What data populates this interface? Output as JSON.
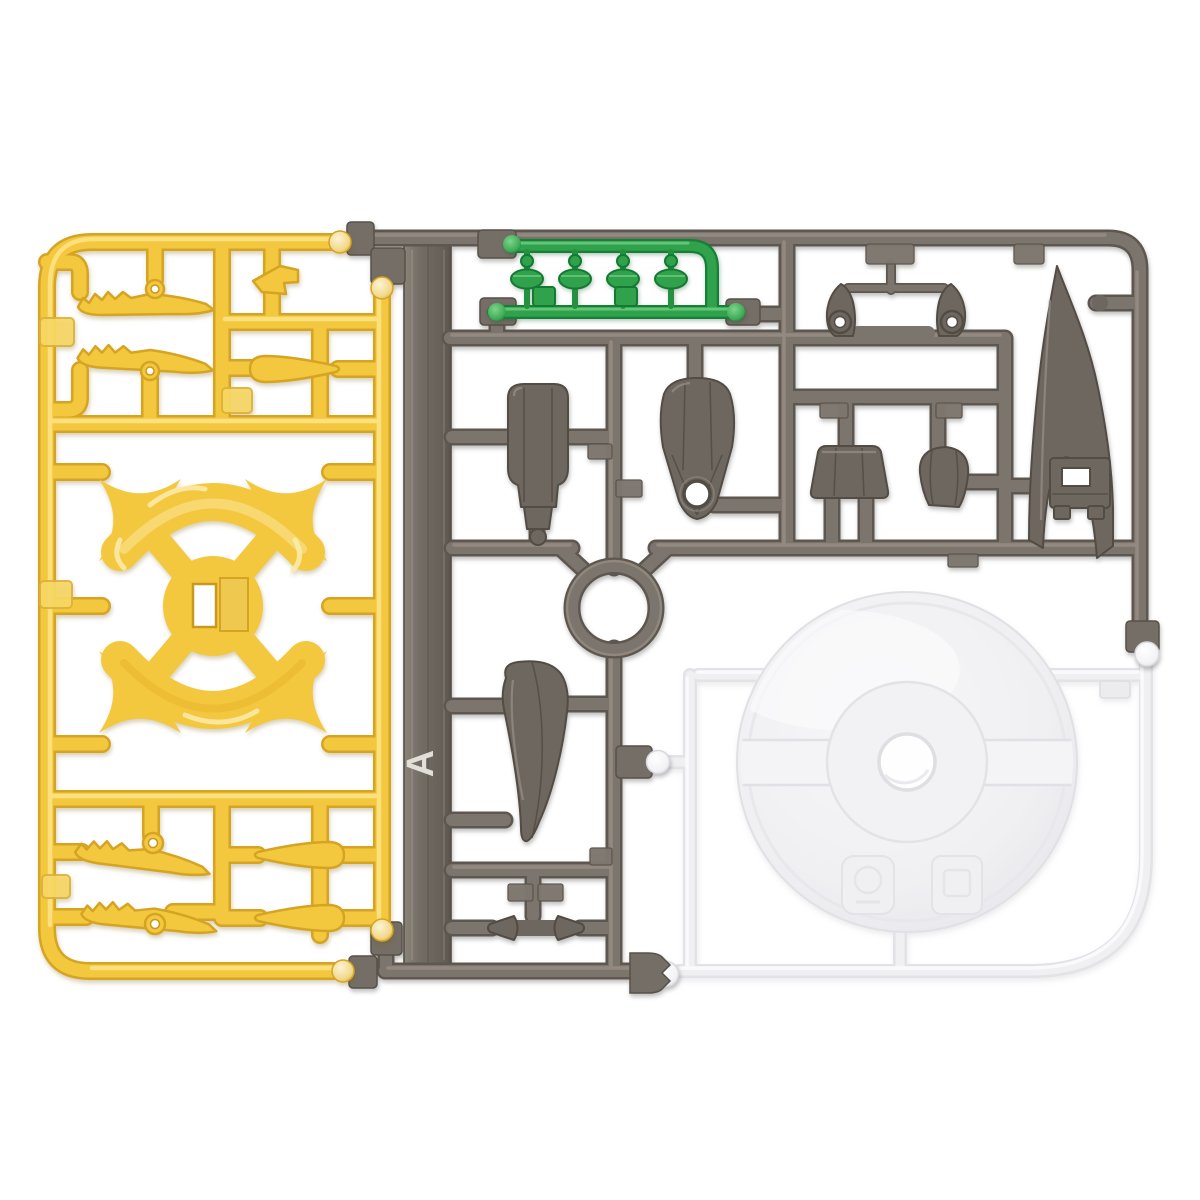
{
  "image": {
    "type": "product-photo",
    "subject": "plastic model kit runner sprues laid flat on a white background",
    "background_color": "#FFFFFF"
  },
  "palette": {
    "yellow_mid": "#F3C83E",
    "yellow_dark": "#D5A422",
    "yellow_hi": "#FCE488",
    "yellow_pale_ball": "#F8ECC2",
    "gray_mid": "#7C756D",
    "gray_dark": "#5E574F",
    "gray_hi": "#998F85",
    "gray_part": "#6E6760",
    "green_mid": "#2FA24B",
    "green_dark": "#178038",
    "clear_mid": "#F0F0F3",
    "clear_dark": "#E2E2E7"
  },
  "yellow_sprue": {
    "position": "left",
    "color_name": "yellow",
    "parts": [
      "serrated-wing-blade-upper-1",
      "serrated-wing-blade-upper-2",
      "small-crest-fin",
      "tail-spike-upper",
      "x-shaped-frame-with-hub",
      "serrated-wing-blade-lower-1",
      "serrated-wing-blade-lower-2",
      "tail-spike-lower-1",
      "tail-spike-lower-2"
    ],
    "gate_tab_count": 4
  },
  "gray_sprue": {
    "position": "center-and-right",
    "color_name": "dark gray",
    "plate_label": "A",
    "parts": [
      "rounded-shell-segment",
      "bell-segment-with-hole",
      "pointed-claw-with-hole-left",
      "pointed-claw-with-hole-right",
      "trapezoid-segment",
      "dome-segment",
      "large-curved-horn",
      "horn-bracket",
      "curved-fang",
      "small-cone-left",
      "small-cone-right"
    ],
    "features": [
      "molding-ring",
      "label-plate-bar",
      "ball-joint-connectors"
    ]
  },
  "green_runner": {
    "position": "top-center",
    "color_name": "green",
    "parts": [
      "joint-peg-1",
      "joint-peg-2",
      "joint-peg-3",
      "joint-peg-4"
    ],
    "gate_tab_count": 2
  },
  "clear_runner": {
    "position": "bottom-right",
    "color_name": "clear",
    "parts": [
      "round-display-base-disc-with-center-hole"
    ],
    "features": [
      "embossed-logo-mark-left",
      "embossed-logo-mark-right",
      "ball-joint-connectors"
    ]
  }
}
